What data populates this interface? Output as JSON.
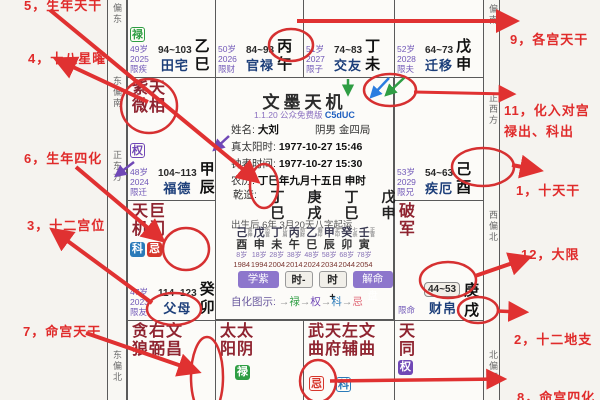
{
  "app": {
    "title": "文墨天机",
    "version": "1.1.20 公众免费版",
    "code": "C5dUC"
  },
  "annotations": {
    "left": [
      {
        "text": "5，生年天干"
      },
      {
        "text": "4，十八星曜"
      },
      {
        "text": "6，生年四化"
      },
      {
        "text": "3，十二宫位"
      },
      {
        "text": "7，命宫天干"
      }
    ],
    "right": [
      {
        "text": "9，各宫天干"
      },
      {
        "text": "11，化入对宫",
        "text2": "禄出、科出"
      },
      {
        "text": "1，十天干"
      },
      {
        "text": "12，大限"
      },
      {
        "text": "2，十二地支"
      },
      {
        "text": "8，命宫四化"
      }
    ]
  },
  "compass": {
    "left": [
      "偏东",
      "东偏南",
      "正东方",
      "东偏北"
    ],
    "right": [
      "偏南",
      "正西方",
      "西偏北",
      "北偏西"
    ]
  },
  "palaces": {
    "tianzhai": {
      "badge": "禄",
      "age": "49岁",
      "year": "2025",
      "limit": "限疾",
      "range": "94~103",
      "name": "田宅",
      "stem": "乙",
      "branch": "巳"
    },
    "guanlu": {
      "age": "50岁",
      "year": "2026",
      "limit": "限财",
      "range": "84~93",
      "name": "官禄",
      "stem": "丙",
      "branch": "午"
    },
    "jiaoyou": {
      "age": "51岁",
      "year": "2027",
      "limit": "限子",
      "range": "74~83",
      "name": "交友",
      "stem": "丁",
      "branch": "未"
    },
    "qianyi": {
      "age": "52岁",
      "year": "2028",
      "limit": "限夫",
      "range": "64~73",
      "name": "迁移",
      "stem": "戊",
      "branch": "申"
    },
    "fude": {
      "stars_row1": "紫天",
      "stars_row2": "微相",
      "badge": "权",
      "age": "48岁",
      "year": "2024",
      "limit": "限迁",
      "range": "104~113",
      "name": "福德",
      "stem": "甲",
      "branch": "辰"
    },
    "jie": {
      "age": "53岁",
      "year": "2029",
      "limit": "限兄",
      "range": "54~63",
      "name": "疾厄",
      "stem": "己",
      "branch": "酉"
    },
    "fumu": {
      "stars_row1": "天巨",
      "stars_row2": "机门",
      "badge_ke": "科",
      "badge_ji": "忌",
      "age": "47岁",
      "year": "2023",
      "limit": "限友",
      "range": "114~123",
      "name": "父母",
      "stem": "癸",
      "branch": "卯"
    },
    "caibo": {
      "stars_row1": "破",
      "stars_row2": "军",
      "limit": "限命",
      "range": "44~53",
      "name": "财帛",
      "stem": "庚",
      "branch": "戌"
    },
    "ming": {
      "stars_row1": "贪右文",
      "stars_row2": "狼弼昌"
    },
    "chou": {
      "stars_row1": "太太",
      "stars_row2": "阳阴",
      "badge": "禄"
    },
    "zi": {
      "stars_row1": "武天左文",
      "stars_row2": "曲府辅曲",
      "badge_ji": "忌",
      "badge_ke": "科"
    },
    "hai": {
      "stars_row1": "天",
      "stars_row2": "同",
      "badge": "权"
    }
  },
  "center": {
    "name_label": "姓名:",
    "name": "大刘",
    "gender": "阴男 金四局",
    "solar_label": "真太阳时:",
    "solar": "1977-10-27  15:46",
    "clock_label": "钟表时间:",
    "clock": "1977-10-27  15:30",
    "lunar_label": "农历:",
    "lunar": "丁巳年九月十五日 申时",
    "qianzao_label": "乾造:",
    "bazi_stems": [
      "丁",
      "庚",
      "丁",
      "戊"
    ],
    "bazi_branches": [
      "巳",
      "戌",
      "巳",
      "申"
    ],
    "qiyun": "出生后 6年 3月20天八字起运",
    "dayun": {
      "stems": [
        "己",
        "戊",
        "丁",
        "丙",
        "乙",
        "甲",
        "癸",
        "壬"
      ],
      "gods": [
        "食神",
        "伤官",
        "比肩",
        "劫财",
        "偏印",
        "正印",
        "七杀",
        "正官"
      ],
      "branches": [
        "酉",
        "申",
        "未",
        "午",
        "巳",
        "辰",
        "卯",
        "寅"
      ],
      "ages": [
        "8岁",
        "18岁",
        "28岁",
        "38岁",
        "48岁",
        "58岁",
        "68岁",
        "78岁"
      ],
      "years": [
        "1984",
        "1994",
        "2004",
        "2014",
        "2024",
        "2034",
        "2044",
        "2054"
      ]
    },
    "buttons": [
      "学紫微",
      "时-",
      "时+",
      "解命盘"
    ],
    "legend_label": "自化图示:",
    "legend": [
      "禄",
      "权",
      "科",
      "忌"
    ]
  },
  "colors": {
    "lu_green": "#2f9e44",
    "quan_purple": "#7048b6",
    "ke_blue": "#2a7ab9",
    "ji_red": "#d6362b",
    "annotation_red": "#e02b2b",
    "star_maroon": "#8f2430",
    "palace_navy": "#1d3f7a"
  }
}
